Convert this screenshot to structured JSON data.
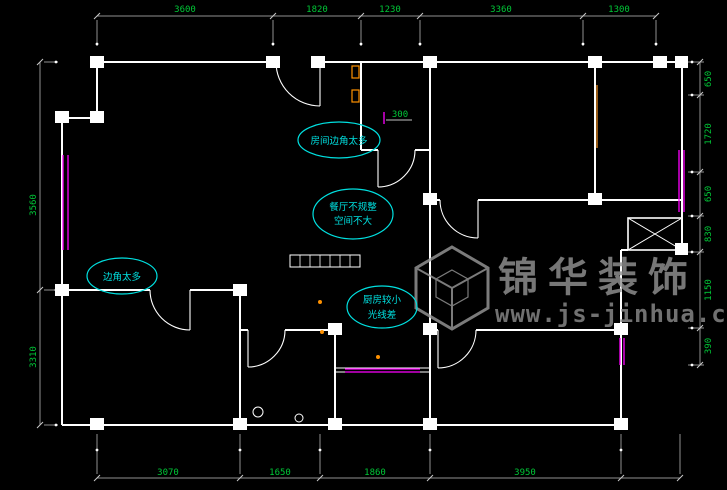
{
  "drawing": {
    "type": "apartment-floor-plan",
    "background": "#000000"
  },
  "dimensions": {
    "top": [
      "3600",
      "1820",
      "1230",
      "3360",
      "1300"
    ],
    "bottom": [
      "3070",
      "1650",
      "1860",
      "3950"
    ],
    "left": [
      "3560",
      "3310"
    ],
    "right": [
      "650",
      "1720",
      "650",
      "830",
      "1150",
      "390"
    ],
    "inline": [
      "300"
    ]
  },
  "annotations": [
    {
      "lines": [
        "房间边角太多"
      ]
    },
    {
      "lines": [
        "餐厅不规整",
        "空间不大"
      ]
    },
    {
      "lines": [
        "边角太多"
      ]
    },
    {
      "lines": [
        "厨房较小",
        "光线差"
      ]
    }
  ],
  "watermark": {
    "logo_icon": "isometric-cube-logo",
    "brand": "锦华装饰",
    "url": "www.js-jinhua.com"
  },
  "colors": {
    "wall": "#ffffff",
    "dimension_line": "#909090",
    "dimension_text": "#00c837",
    "annotation": "#00e0e0",
    "window": "#ff00ff",
    "accent": "#ff9100",
    "watermark": "#929292"
  }
}
